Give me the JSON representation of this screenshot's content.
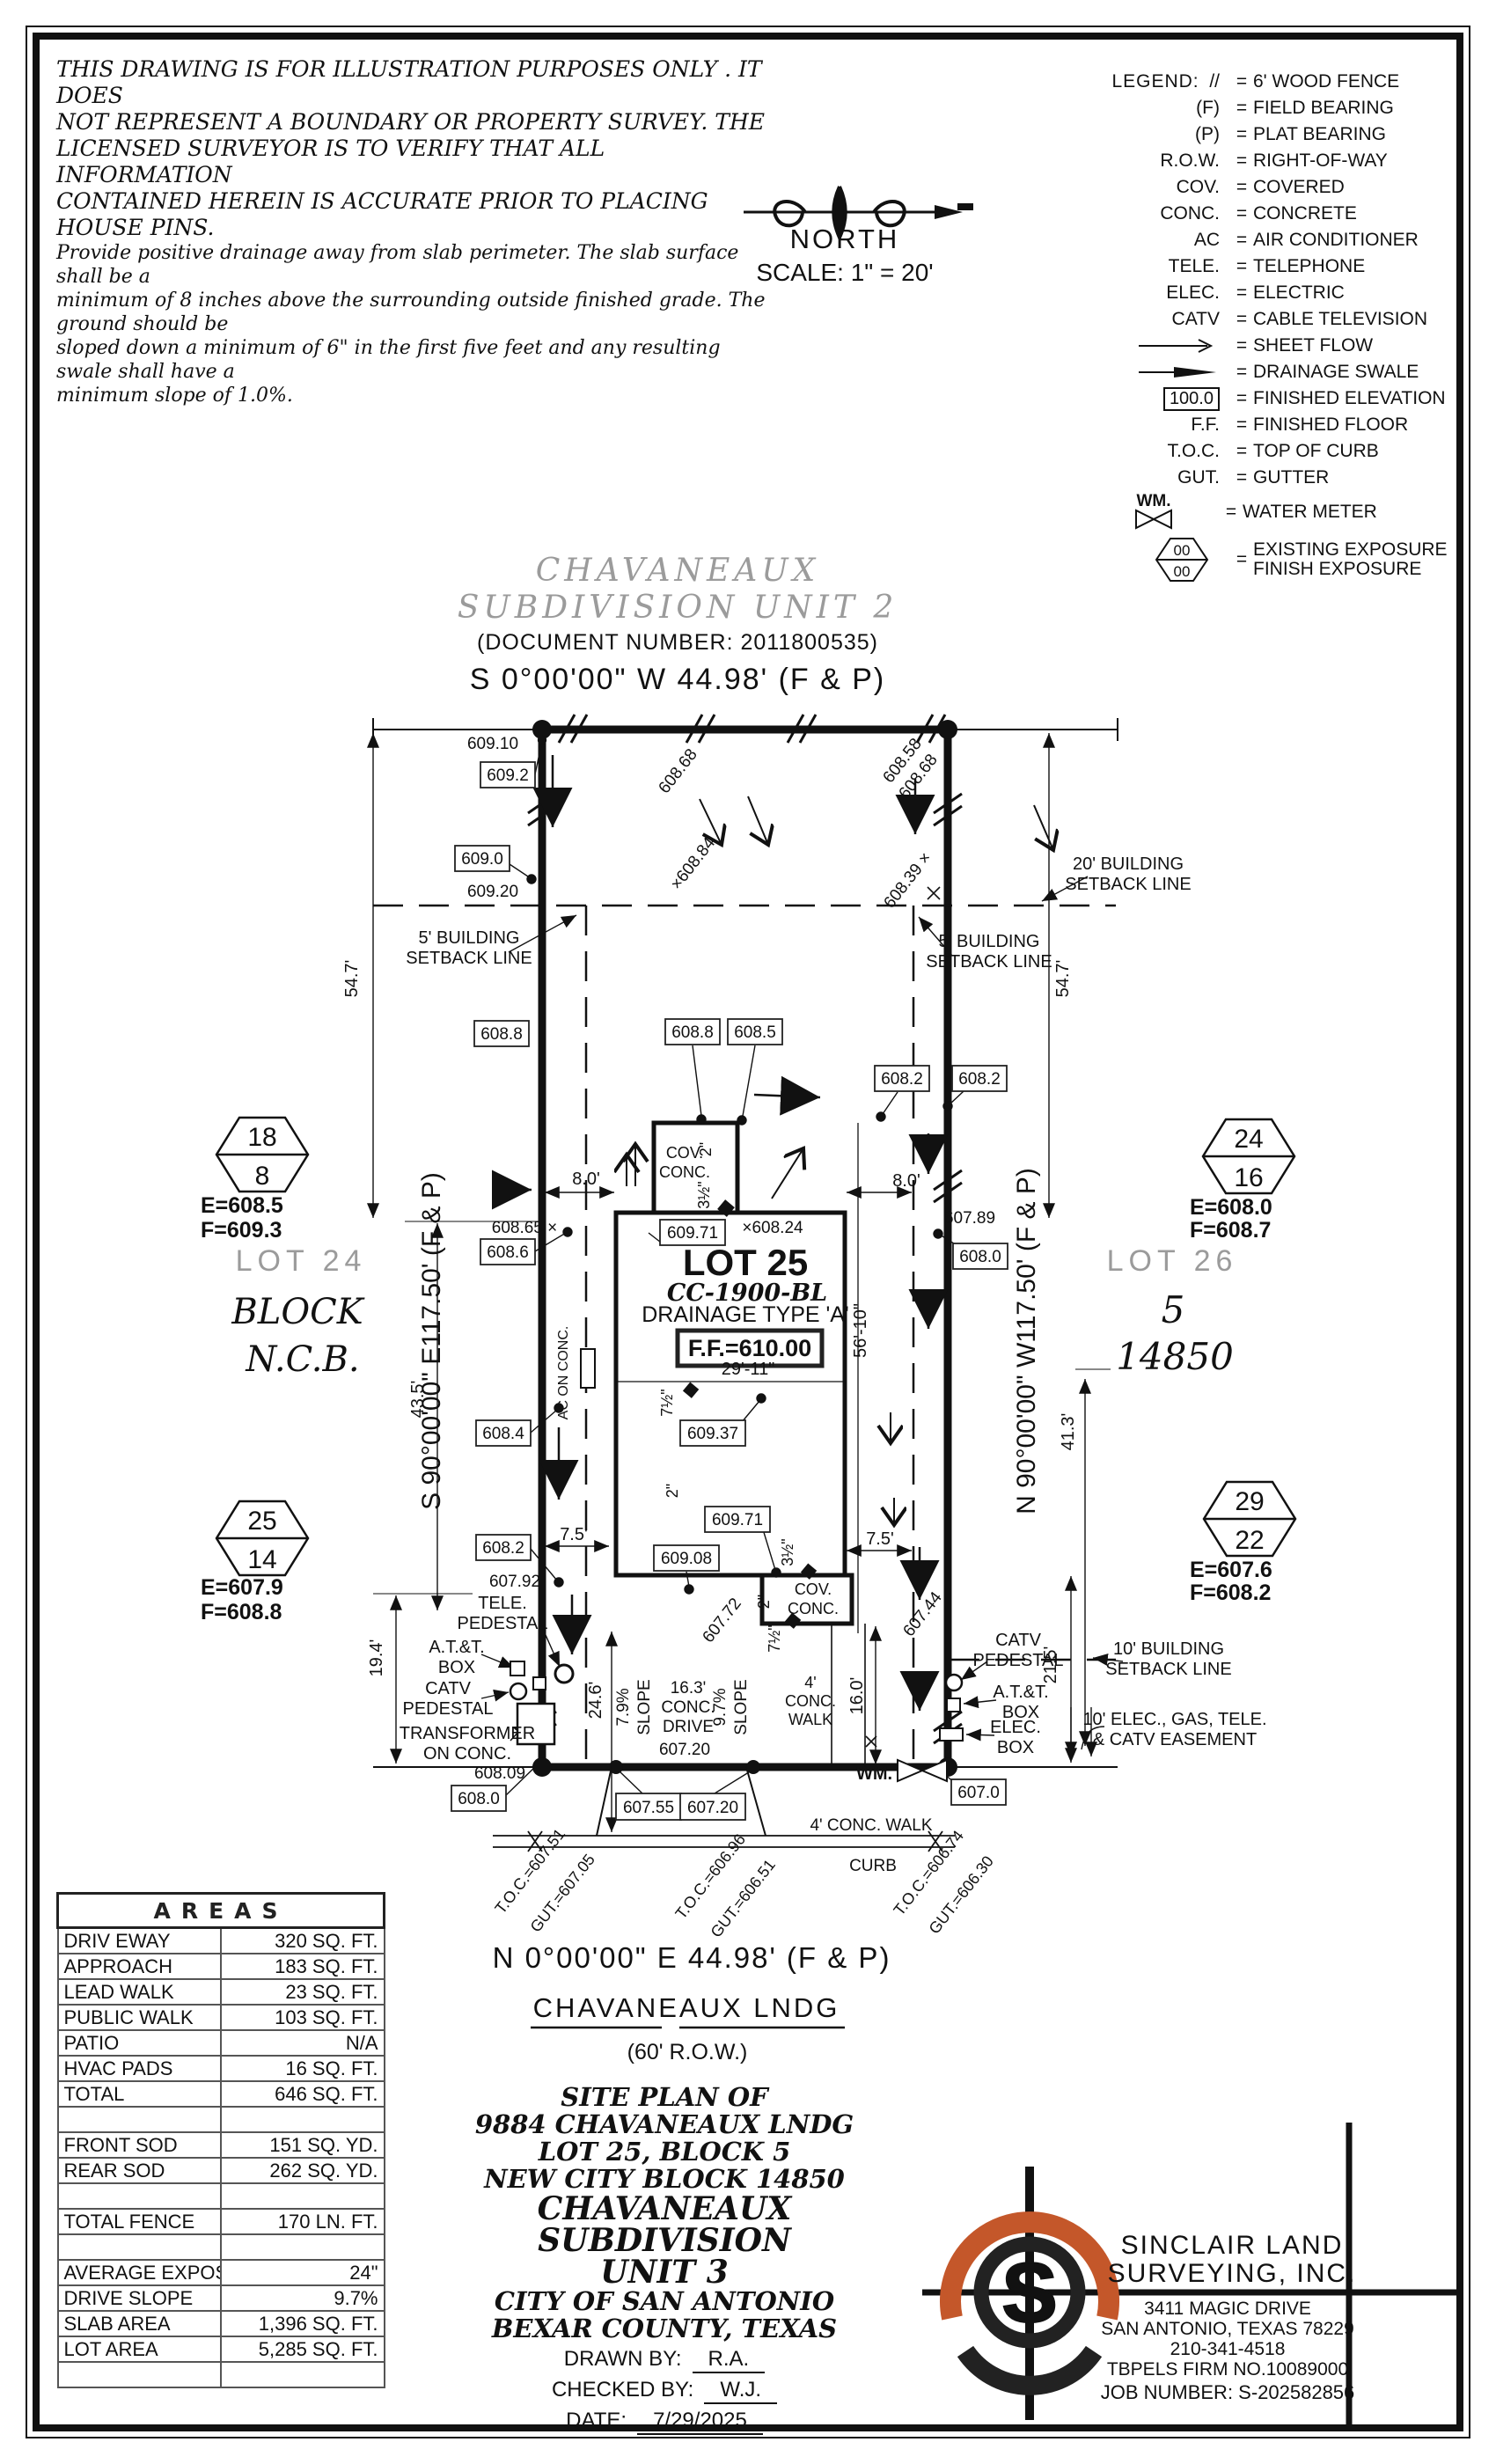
{
  "colors": {
    "accent": "#c4572a",
    "gray": "#9b9b9b",
    "ink": "#111111"
  },
  "disclaimer": {
    "l1": "THIS DRAWING IS FOR ILLUSTRATION PURPOSES ONLY . IT DOES",
    "l2": "NOT REPRESENT A BOUNDARY OR PROPERTY SURVEY. THE",
    "l3": "LICENSED SURVEYOR IS TO VERIFY THAT ALL INFORMATION",
    "l4": "CONTAINED HEREIN IS ACCURATE PRIOR TO PLACING HOUSE PINS.",
    "n1": "Provide positive drainage away from slab perimeter. The slab surface shall be a",
    "n2": "minimum of 8 inches above the surrounding outside finished grade. The ground should be",
    "n3": "sloped down a minimum of 6\" in the first five feet and any resulting swale shall have a",
    "n4": "minimum slope of 1.0%."
  },
  "north": {
    "label": "NORTH",
    "scale": "SCALE:  1\" = 20'"
  },
  "legend": {
    "title": "LEGEND:",
    "eq": "=",
    "items": [
      {
        "sym": "//",
        "label": "6' WOOD FENCE"
      },
      {
        "sym": "(F)",
        "label": "FIELD BEARING"
      },
      {
        "sym": "(P)",
        "label": "PLAT BEARING"
      },
      {
        "sym": "R.O.W.",
        "label": "RIGHT-OF-WAY"
      },
      {
        "sym": "COV.",
        "label": "COVERED"
      },
      {
        "sym": "CONC.",
        "label": "CONCRETE"
      },
      {
        "sym": "AC",
        "label": "AIR CONDITIONER"
      },
      {
        "sym": "TELE.",
        "label": "TELEPHONE"
      },
      {
        "sym": "ELEC.",
        "label": "ELECTRIC"
      },
      {
        "sym": "CATV",
        "label": "CABLE TELEVISION"
      }
    ],
    "sheet_flow": "SHEET FLOW",
    "drainage_swale": "DRAINAGE SWALE",
    "finished_elev_sym": "100.0",
    "finished_elev": "FINISHED ELEVATION",
    "ff_sym": "F.F.",
    "ff": "FINISHED FLOOR",
    "toc_sym": "T.O.C.",
    "toc": "TOP OF CURB",
    "gut_sym": "GUT.",
    "gut": "GUTTER",
    "wm_sym": "WM.",
    "wm": "WATER METER",
    "hex_top": "00",
    "hex_bottom": "00",
    "existing_exposure": "EXISTING EXPOSURE",
    "finish_exposure": "FINISH EXPOSURE"
  },
  "header": {
    "subdivision_line1": "CHAVANEAUX",
    "subdivision_line2": "SUBDIVISION  UNIT  2",
    "document": "(DOCUMENT NUMBER:  2011800535)",
    "bearing_north": "S 0°00'00\" W  44.98'  (F & P)"
  },
  "plan": {
    "bearing_left": "S 90°00'00\" E117.50' (F & P)",
    "bearing_right": "N 90°00'00\" W117.50' (F & P)",
    "lot25": {
      "name": "LOT 25",
      "code": "CC-1900-BL",
      "drainage": "DRAINAGE TYPE 'A'",
      "ff": "F.F.=610.00"
    },
    "lot24": {
      "hex_top": "18",
      "hex_bottom": "8",
      "e": "E=608.5",
      "f": "F=609.3",
      "name": "LOT 24",
      "block": "BLOCK",
      "ncb": "N.C.B."
    },
    "lot26": {
      "hex_top": "24",
      "hex_bottom": "16",
      "e": "E=608.0",
      "f": "F=608.7",
      "name": "LOT 26",
      "block": "5",
      "ncb": "14850"
    },
    "hex_sw": {
      "hex_top": "25",
      "hex_bottom": "14",
      "e": "E=607.9",
      "f": "F=608.8"
    },
    "hex_se": {
      "hex_top": "29",
      "hex_bottom": "22",
      "e": "E=607.6",
      "f": "F=608.2"
    },
    "setbacks": {
      "s5a": "5' BUILDING",
      "s5b": "SETBACK LINE",
      "s20a": "20' BUILDING",
      "s20b": "SETBACK LINE",
      "s10a": "10' BUILDING",
      "s10b": "SETBACK LINE",
      "easea": "10' ELEC., GAS, TELE.",
      "easeb": "& CATV EASEMENT"
    },
    "dims": {
      "d54": "54.7'",
      "d43": "43.5'",
      "d19": "19.4'",
      "d41": "41.3'",
      "d21": "21.5'",
      "d24": "24.6'",
      "d16": "16.0'",
      "d8": "8.0'",
      "d75": "7.5'",
      "d29": "29'-11\"",
      "d56": "56'-10\"",
      "i2": "2\"",
      "i35": "3½\"",
      "i75": "7½\""
    },
    "elev": {
      "b609_2": "609.2",
      "b609_0": "609.0",
      "b608_8l": "608.8",
      "b608_6": "608.6",
      "b608_4": "608.4",
      "b608_2l": "608.2",
      "b608_0l": "608.0",
      "b608_8c": "608.8",
      "b608_5c": "608.5",
      "b608_2c": "608.2",
      "b608_2r": "608.2",
      "b608_0r": "608.0",
      "b609_71a": "609.71",
      "b609_37": "609.37",
      "b609_71b": "609.71",
      "b609_08": "609.08",
      "b607_55": "607.55",
      "b607_20": "607.20",
      "b607_0": "607.0",
      "f609_10": "609.10",
      "f609_20": "609.20",
      "f608_65": "608.65 ×",
      "f607_92": "607.92",
      "f608_09": "608.09",
      "f607_89": "607.89",
      "fx608_24": "×608.24",
      "f607_20": "607.20",
      "r608_68": "608.68",
      "r608_84": "×608.84",
      "r608_58": "608.58",
      "r608_39": "608.39 ×",
      "r607_72": "607.72",
      "r607_44": "607.44"
    },
    "util": {
      "tele1": "TELE.",
      "tele2": "PEDESTAL",
      "att1": "A.T.&T.",
      "att2": "BOX",
      "catv1": "CATV",
      "catv2": "PEDESTAL",
      "trans1": "TRANSFORMER",
      "trans2": "ON CONC.",
      "elec1": "ELEC.",
      "elec2": "BOX",
      "wm": "WM.",
      "ac": "AC ON CONC."
    },
    "surface": {
      "cov1": "COV.",
      "cov2": "CONC.",
      "s79": "7.9%",
      "s97": "9.7%",
      "slope": "SLOPE",
      "drv1": "16.3'",
      "drv2": "CONC.",
      "drv3": "DRIVE",
      "wk1": "4'",
      "wk2": "CONC.",
      "wk3": "WALK",
      "walk": "4' CONC. WALK",
      "curb": "CURB"
    },
    "toc": {
      "t1a": "T.O.C.=607.51",
      "t1b": "GUT.=607.05",
      "t2a": "T.O.C.=606.96",
      "t2b": "GUT.=606.51",
      "t3a": "T.O.C.=606.74",
      "t3b": "GUT.=606.30"
    }
  },
  "street": {
    "bearing_south": "N 0°00'00\" E  44.98'  (F & P)",
    "name": "CHAVANEAUX LNDG",
    "row": "(60' R.O.W.)"
  },
  "areas_table": {
    "title": "AREAS",
    "rows": [
      {
        "label": "DRIV EWAY",
        "value": "320 SQ. FT."
      },
      {
        "label": "APPROACH",
        "value": "183 SQ. FT."
      },
      {
        "label": "LEAD WALK",
        "value": "23 SQ. FT."
      },
      {
        "label": "PUBLIC WALK",
        "value": "103 SQ. FT."
      },
      {
        "label": "PATIO",
        "value": "N/A"
      },
      {
        "label": "HVAC PADS",
        "value": "16 SQ. FT."
      },
      {
        "label": "TOTAL",
        "value": "646 SQ. FT."
      },
      {
        "label": "",
        "value": ""
      },
      {
        "label": "FRONT SOD",
        "value": "151 SQ. YD."
      },
      {
        "label": "REAR SOD",
        "value": "262 SQ. YD."
      },
      {
        "label": "",
        "value": ""
      },
      {
        "label": "TOTAL FENCE",
        "value": "170 LN. FT."
      },
      {
        "label": "",
        "value": ""
      },
      {
        "label": "AVERAGE EXPOSURE",
        "value": "24\""
      },
      {
        "label": "DRIVE SLOPE",
        "value": "9.7%"
      },
      {
        "label": "SLAB AREA",
        "value": "1,396 SQ. FT."
      },
      {
        "label": "LOT AREA",
        "value": "5,285 SQ. FT."
      },
      {
        "label": "",
        "value": ""
      }
    ]
  },
  "site_info": {
    "lines": [
      "SITE PLAN OF",
      "9884 CHAVANEAUX LNDG",
      "LOT 25, BLOCK 5",
      "NEW CITY BLOCK 14850",
      "CHAVANEAUX SUBDIVISION",
      "UNIT 3",
      "CITY OF SAN ANTONIO",
      "BEXAR COUNTY, TEXAS"
    ],
    "drawn_by_label": "DRAWN BY:",
    "drawn_by": "R.A.",
    "checked_by_label": "CHECKED BY:",
    "checked_by": "W.J.",
    "date_label": "DATE:",
    "date": "7/29/2025"
  },
  "surveyor": {
    "logo_letter": "S",
    "name1": "SINCLAIR LAND",
    "name2": "SURVEYING, INC.",
    "address1": "3411 MAGIC DRIVE",
    "address2": "SAN ANTONIO, TEXAS 78229",
    "phone": "210-341-4518",
    "firm": "TBPELS FIRM NO.10089000",
    "job": "JOB NUMBER: S-202582856"
  }
}
